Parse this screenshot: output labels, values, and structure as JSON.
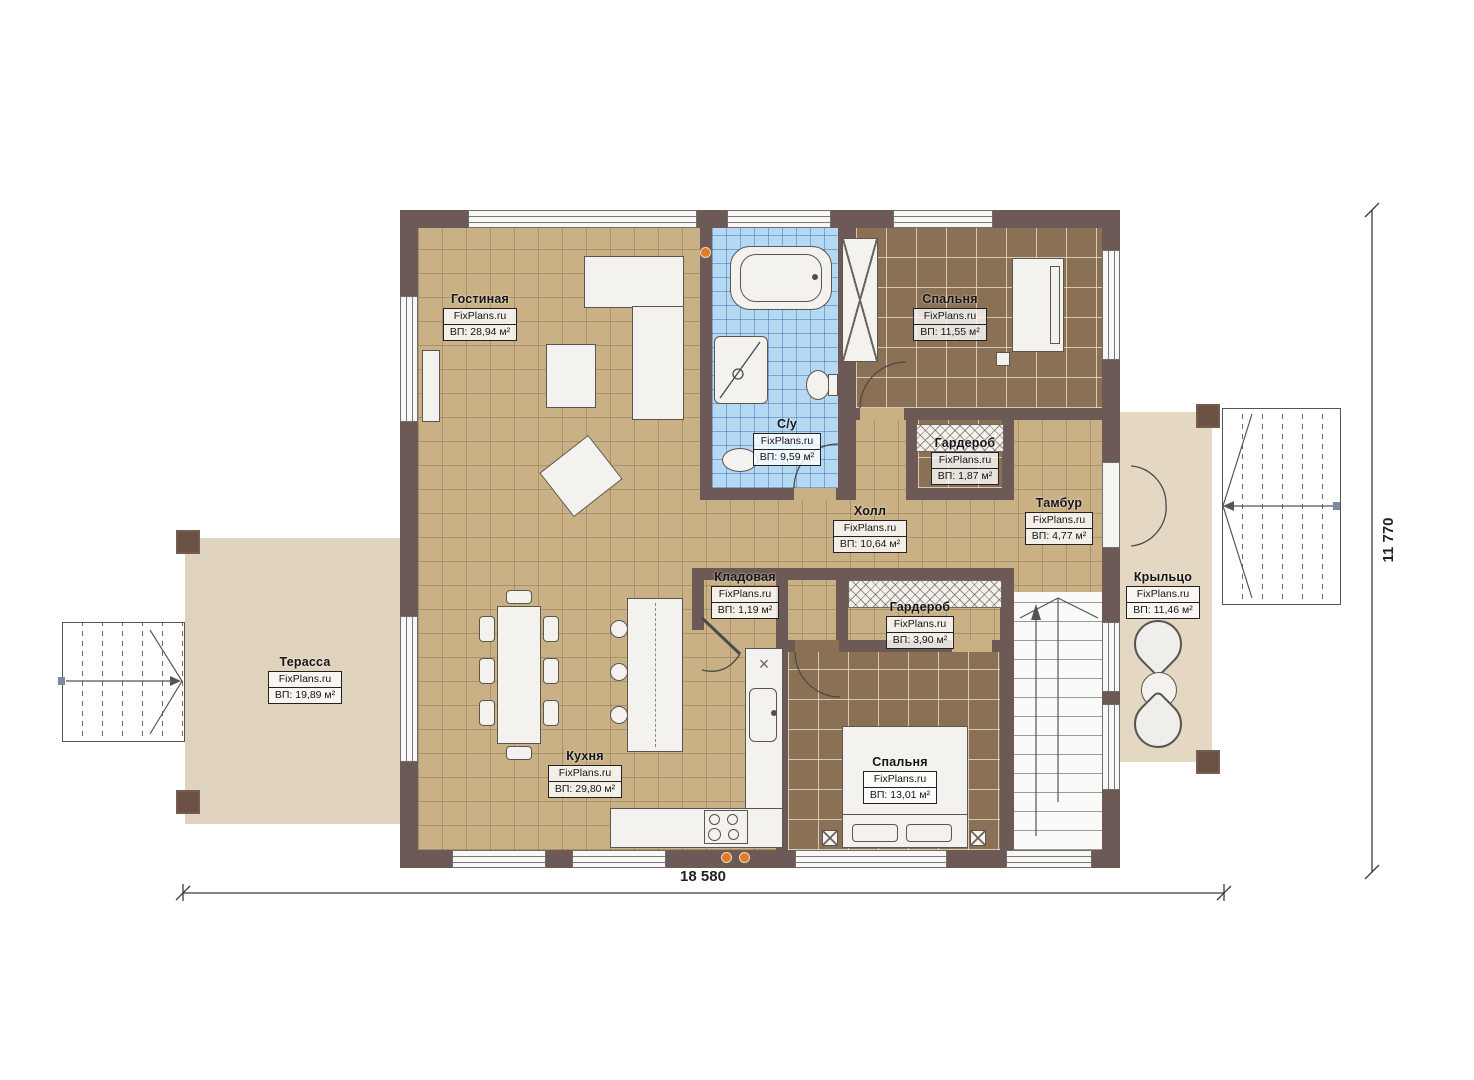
{
  "brand": "FixPlans.ru",
  "dimensions": {
    "width_label": "18 580",
    "height_label": "11 770"
  },
  "rooms": [
    {
      "name": "Гостиная",
      "area": "ВП: 28,94 м²"
    },
    {
      "name": "С/у",
      "area": "ВП: 9,59 м²"
    },
    {
      "name": "Спальня",
      "area": "ВП: 11,55 м²"
    },
    {
      "name": "Гардероб",
      "area": "ВП: 1,87 м²"
    },
    {
      "name": "Холл",
      "area": "ВП: 10,64 м²"
    },
    {
      "name": "Тамбур",
      "area": "ВП: 4,77 м²"
    },
    {
      "name": "Кладовая",
      "area": "ВП: 1,19 м²"
    },
    {
      "name": "Гардероб",
      "area": "ВП: 3,90 м²"
    },
    {
      "name": "Кухня",
      "area": "ВП: 29,80 м²"
    },
    {
      "name": "Спальня",
      "area": "ВП: 13,01 м²"
    },
    {
      "name": "Терасса",
      "area": "ВП: 19,89 м²"
    },
    {
      "name": "Крыльцо",
      "area": "ВП: 11,46 м²"
    }
  ],
  "colors": {
    "wall": "#6d5a56",
    "floor_wood": "#c9b185",
    "floor_tile_dark": "#8a7155",
    "floor_bath": "#b5d8f3",
    "terrace": "#e0d3bd",
    "porch": "#e5d8c2",
    "accent_dot": "#e87a1e"
  }
}
